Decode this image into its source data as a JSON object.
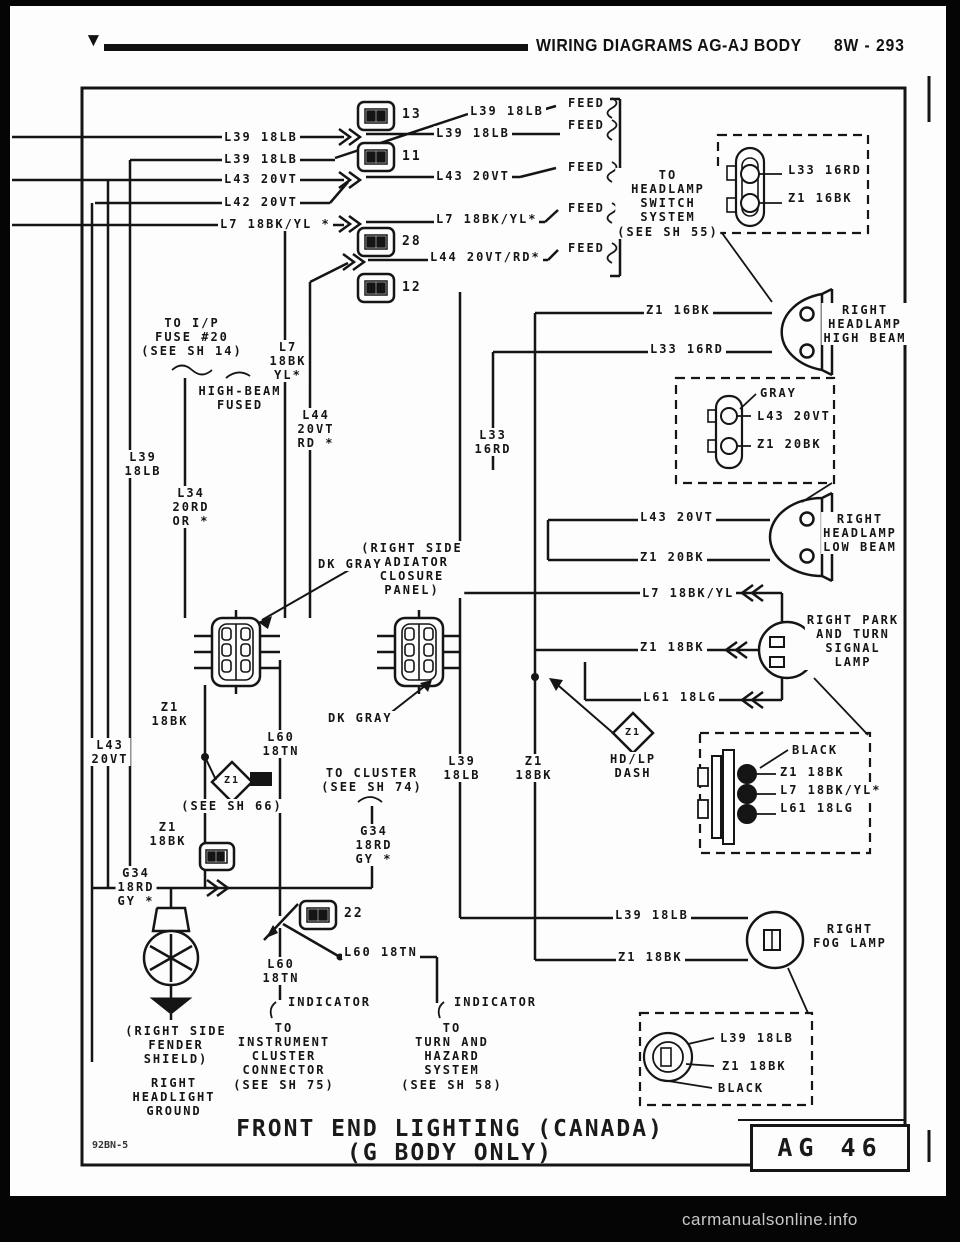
{
  "header": {
    "marker": "▼",
    "title": "WIRING DIAGRAMS AG-AJ BODY",
    "page_code": "8W - 293"
  },
  "titleblock": {
    "line1": "FRONT END LIGHTING (CANADA)",
    "line2": "(G BODY ONLY)",
    "page_ref": "AG 46",
    "doc_code": "92BN-5"
  },
  "watermark": "carmanualsonline.info",
  "colors": {
    "paper": "#fdfdfd",
    "ink": "#151515",
    "surround": "#000000",
    "watermark": "#c8c8c8"
  },
  "icons": [
    "inline-connector-box-icon",
    "double-chevron-connector-icon",
    "headlamp-icon",
    "park-turn-lamp-icon",
    "fog-lamp-icon",
    "bulb-icon",
    "ground-icon",
    "splice-diamond-icon",
    "six-pin-connector-icon",
    "bulb-socket-connector-icon",
    "three-pin-connector-icon",
    "feed-break-icon",
    "switch-arrow-icon"
  ],
  "connector_numbers": [
    "13",
    "11",
    "28",
    "12",
    "22"
  ],
  "labels": [
    {
      "n": "wire-label-l39-a",
      "t": "L39 18LB",
      "x": 222,
      "y": 130
    },
    {
      "n": "wire-label-l39-b",
      "t": "L39 18LB",
      "x": 222,
      "y": 152
    },
    {
      "n": "wire-label-l43-a",
      "t": "L43 20VT",
      "x": 222,
      "y": 172
    },
    {
      "n": "wire-label-l42-a",
      "t": "L42 20VT",
      "x": 222,
      "y": 195
    },
    {
      "n": "wire-label-l7-a",
      "t": "L7 18BK/YL *",
      "x": 218,
      "y": 217
    },
    {
      "n": "wire-label-l39-c",
      "t": "L39 18LB",
      "x": 468,
      "y": 104
    },
    {
      "n": "wire-label-l39-d",
      "t": "L39 18LB",
      "x": 434,
      "y": 126
    },
    {
      "n": "wire-label-l43-b",
      "t": "L43 20VT",
      "x": 434,
      "y": 169
    },
    {
      "n": "wire-label-l7-b",
      "t": "L7 18BK/YL*",
      "x": 434,
      "y": 212
    },
    {
      "n": "wire-label-l44-a",
      "t": "L44 20VT/RD*",
      "x": 428,
      "y": 250
    },
    {
      "n": "feed-label-1",
      "t": "FEED",
      "x": 566,
      "y": 96
    },
    {
      "n": "feed-label-2",
      "t": "FEED",
      "x": 566,
      "y": 118
    },
    {
      "n": "feed-label-3",
      "t": "FEED",
      "x": 566,
      "y": 160
    },
    {
      "n": "feed-label-4",
      "t": "FEED",
      "x": 566,
      "y": 201
    },
    {
      "n": "feed-label-5",
      "t": "FEED",
      "x": 566,
      "y": 241
    },
    {
      "n": "connector-number-13",
      "t": "13",
      "x": 400,
      "y": 107,
      "fs": 13
    },
    {
      "n": "connector-number-11",
      "t": "11",
      "x": 400,
      "y": 149,
      "fs": 13
    },
    {
      "n": "connector-number-28",
      "t": "28",
      "x": 400,
      "y": 234,
      "fs": 13
    },
    {
      "n": "connector-number-12",
      "t": "12",
      "x": 400,
      "y": 280,
      "fs": 13
    },
    {
      "n": "connector-number-22",
      "t": "22",
      "x": 342,
      "y": 906,
      "fs": 13
    },
    {
      "n": "note-headlamp-switch",
      "t": "TO\nHEADLAMP\nSWITCH\nSYSTEM\n(SEE SH 55)",
      "x": 668,
      "y": 168,
      "al": "c"
    },
    {
      "n": "wire-label-l33-inset",
      "t": "L33 16RD",
      "x": 786,
      "y": 163
    },
    {
      "n": "wire-label-z1-inset",
      "t": "Z1 16BK",
      "x": 786,
      "y": 191
    },
    {
      "n": "wire-label-z1-16bk",
      "t": "Z1 16BK",
      "x": 644,
      "y": 303
    },
    {
      "n": "wire-label-l33-16rd",
      "t": "L33 16RD",
      "x": 648,
      "y": 342
    },
    {
      "n": "component-label-high-beam",
      "t": "RIGHT\nHEADLAMP\nHIGH BEAM",
      "x": 865,
      "y": 303,
      "al": "c"
    },
    {
      "n": "connector-color-gray",
      "t": "GRAY",
      "x": 758,
      "y": 386
    },
    {
      "n": "wire-label-l43-inset",
      "t": "L43 20VT",
      "x": 755,
      "y": 409
    },
    {
      "n": "wire-label-z1-20bk-inset",
      "t": "Z1 20BK",
      "x": 755,
      "y": 437
    },
    {
      "n": "wire-label-l43-c",
      "t": "L43 20VT",
      "x": 638,
      "y": 510
    },
    {
      "n": "wire-label-z1-20bk",
      "t": "Z1 20BK",
      "x": 638,
      "y": 550
    },
    {
      "n": "component-label-low-beam",
      "t": "RIGHT\nHEADLAMP\nLOW BEAM",
      "x": 860,
      "y": 512,
      "al": "c"
    },
    {
      "n": "wire-label-l7-b2",
      "t": "L7 18BK/YL",
      "x": 640,
      "y": 586
    },
    {
      "n": "wire-label-z1-18bk-a",
      "t": "Z1 18BK",
      "x": 638,
      "y": 640
    },
    {
      "n": "wire-label-l61",
      "t": "L61 18LG",
      "x": 641,
      "y": 690
    },
    {
      "n": "component-label-park-turn",
      "t": "RIGHT PARK\nAND TURN\nSIGNAL\nLAMP",
      "x": 853,
      "y": 613,
      "al": "c"
    },
    {
      "n": "connector-color-black-a",
      "t": "BLACK",
      "x": 790,
      "y": 743
    },
    {
      "n": "wire-label-z1-inset2",
      "t": "Z1 18BK",
      "x": 778,
      "y": 765
    },
    {
      "n": "wire-label-l7-inset2",
      "t": "L7 18BK/YL*",
      "x": 778,
      "y": 783
    },
    {
      "n": "wire-label-l61-inset2",
      "t": "L61 18LG",
      "x": 778,
      "y": 801
    },
    {
      "n": "wire-label-l39-fog",
      "t": "L39 18LB",
      "x": 613,
      "y": 908
    },
    {
      "n": "wire-label-z1-fog",
      "t": "Z1 18BK",
      "x": 616,
      "y": 950
    },
    {
      "n": "component-label-fog",
      "t": "RIGHT\nFOG LAMP",
      "x": 850,
      "y": 922,
      "al": "c"
    },
    {
      "n": "wire-label-l39-inset3",
      "t": "L39 18LB",
      "x": 718,
      "y": 1031
    },
    {
      "n": "wire-label-z1-inset3",
      "t": "Z1 18BK",
      "x": 720,
      "y": 1059
    },
    {
      "n": "connector-color-black-b",
      "t": "BLACK",
      "x": 716,
      "y": 1081
    },
    {
      "n": "note-radiator-panel",
      "t": "(RIGHT SIDE\nRADIATOR\nCLOSURE\nPANEL)",
      "x": 412,
      "y": 541,
      "al": "c"
    },
    {
      "n": "connector-color-dk-gray-a",
      "t": "DK GRAY",
      "x": 316,
      "y": 557
    },
    {
      "n": "connector-color-dk-gray-b",
      "t": "DK GRAY",
      "x": 326,
      "y": 711
    },
    {
      "n": "note-ip-fuse",
      "t": "TO I/P\nFUSE #20\n(SEE SH 14)",
      "x": 192,
      "y": 316,
      "al": "c"
    },
    {
      "n": "note-high-beam-fused",
      "t": "HIGH-BEAM\nFUSED",
      "x": 240,
      "y": 384,
      "al": "c"
    },
    {
      "n": "wire-stack-l7",
      "t": "L7\n18BK\nYL*",
      "x": 288,
      "y": 340,
      "al": "c"
    },
    {
      "n": "wire-stack-l44",
      "t": "L44\n20VT\nRD *",
      "x": 316,
      "y": 408,
      "al": "c"
    },
    {
      "n": "wire-stack-l39-left",
      "t": "L39\n18LB",
      "x": 143,
      "y": 450,
      "al": "c"
    },
    {
      "n": "wire-stack-l34",
      "t": "L34\n20RD\nOR *",
      "x": 191,
      "y": 486,
      "al": "c"
    },
    {
      "n": "wire-stack-l33",
      "t": "L33\n16RD",
      "x": 493,
      "y": 428,
      "al": "c"
    },
    {
      "n": "wire-stack-l43-left",
      "t": "L43\n20VT",
      "x": 110,
      "y": 738,
      "al": "c"
    },
    {
      "n": "wire-stack-z1-left-a",
      "t": "Z1\n18BK",
      "x": 170,
      "y": 700,
      "al": "c"
    },
    {
      "n": "wire-stack-z1-left-b",
      "t": "Z1\n18BK",
      "x": 168,
      "y": 820,
      "al": "c"
    },
    {
      "n": "wire-stack-l39-mid",
      "t": "L39\n18LB",
      "x": 462,
      "y": 754,
      "al": "c"
    },
    {
      "n": "wire-stack-z1-mid",
      "t": "Z1\n18BK",
      "x": 534,
      "y": 754,
      "al": "c"
    },
    {
      "n": "splice-label-hdlp",
      "t": "HD/LP\nDASH",
      "x": 633,
      "y": 752,
      "al": "c"
    },
    {
      "n": "splice-id-z1-a",
      "t": "Z1",
      "x": 232,
      "y": 775,
      "al": "c",
      "fs": 10
    },
    {
      "n": "splice-id-z1-b",
      "t": "Z1",
      "x": 633,
      "y": 727,
      "al": "c",
      "fs": 10
    },
    {
      "n": "wire-stack-l60-a",
      "t": "L60\n18TN",
      "x": 281,
      "y": 730,
      "al": "c"
    },
    {
      "n": "note-cluster-sh74",
      "t": "TO CLUSTER\n(SEE SH 74)",
      "x": 372,
      "y": 766,
      "al": "c"
    },
    {
      "n": "wire-stack-g34-a",
      "t": "G34\n18RD\nGY *",
      "x": 374,
      "y": 824,
      "al": "c"
    },
    {
      "n": "wire-stack-g34-b",
      "t": "G34\n18RD\nGY *",
      "x": 136,
      "y": 866,
      "al": "c"
    },
    {
      "n": "note-see-sh66",
      "t": "(SEE SH 66)",
      "x": 232,
      "y": 799,
      "al": "c"
    },
    {
      "n": "wire-stack-l60-b",
      "t": "L60\n18TN",
      "x": 281,
      "y": 957,
      "al": "c"
    },
    {
      "n": "wire-label-l60",
      "t": "L60 18TN",
      "x": 342,
      "y": 945
    },
    {
      "n": "indicator-label-a",
      "t": "INDICATOR",
      "x": 286,
      "y": 995
    },
    {
      "n": "note-instrument-cluster",
      "t": "TO\nINSTRUMENT\nCLUSTER\nCONNECTOR\n(SEE SH 75)",
      "x": 284,
      "y": 1021,
      "al": "c"
    },
    {
      "n": "indicator-label-b",
      "t": "INDICATOR",
      "x": 452,
      "y": 995
    },
    {
      "n": "note-turn-hazard",
      "t": "TO\nTURN AND\nHAZARD\nSYSTEM\n(SEE SH 58)",
      "x": 452,
      "y": 1021,
      "al": "c"
    },
    {
      "n": "note-fender-shield",
      "t": "(RIGHT SIDE\nFENDER\nSHIELD)",
      "x": 176,
      "y": 1024,
      "al": "c"
    },
    {
      "n": "note-headlight-ground",
      "t": "RIGHT\nHEADLIGHT\nGROUND",
      "x": 174,
      "y": 1076,
      "al": "c"
    }
  ]
}
